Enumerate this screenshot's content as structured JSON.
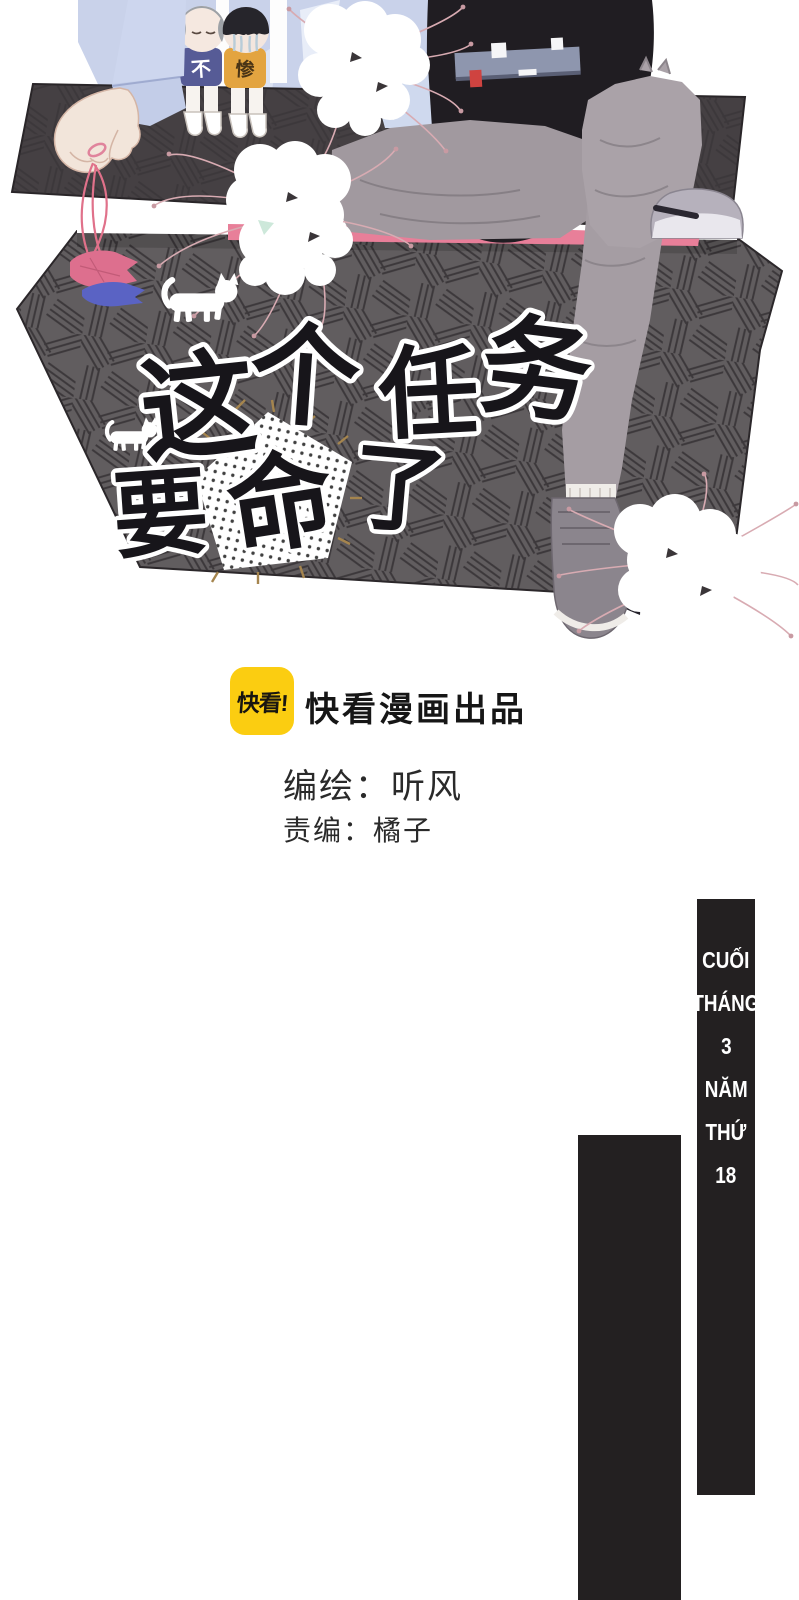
{
  "illustration": {
    "title": {
      "chars": [
        "这",
        "个",
        "任",
        "务",
        "要",
        "命",
        "了"
      ],
      "full_title": "这个任务要命了",
      "accent_char": "命",
      "accent_color": "#f2a3c0"
    },
    "kids": {
      "left_shirt_char": "不",
      "right_shirt_char": "惨"
    },
    "icons": {
      "cat_silhouette": "white walking cat",
      "origami_fish_pink": "pink paper fish on strings",
      "origami_fish_blue": "blue paper fish on strings",
      "spider_lily": "white spider lily cluster",
      "coffin_box": "dark cross-hatched coffin box",
      "pentagon_patch": "white dotted pentagon patch"
    }
  },
  "credits": {
    "logo_text": "快看!",
    "producer": "快看漫画出品",
    "author_line": "编绘：听风",
    "editor_line": "责编：橘子"
  },
  "right_banner": {
    "lines": [
      "CUỐI",
      "THÁNG",
      "3",
      "NĂM",
      "THỨ",
      "18"
    ]
  },
  "colors": {
    "kuaikan_yellow": "#fbcd11",
    "banner_black": "#232021",
    "box_face": "#615d5f",
    "box_lid": "#454043",
    "title_pink": "#f2a3c0",
    "sheet_pink": "#e87f99",
    "shirt_blue": "#c9d2ea",
    "kid_shirt_blue": "#565b96",
    "kid_shirt_orange": "#e3a440"
  }
}
